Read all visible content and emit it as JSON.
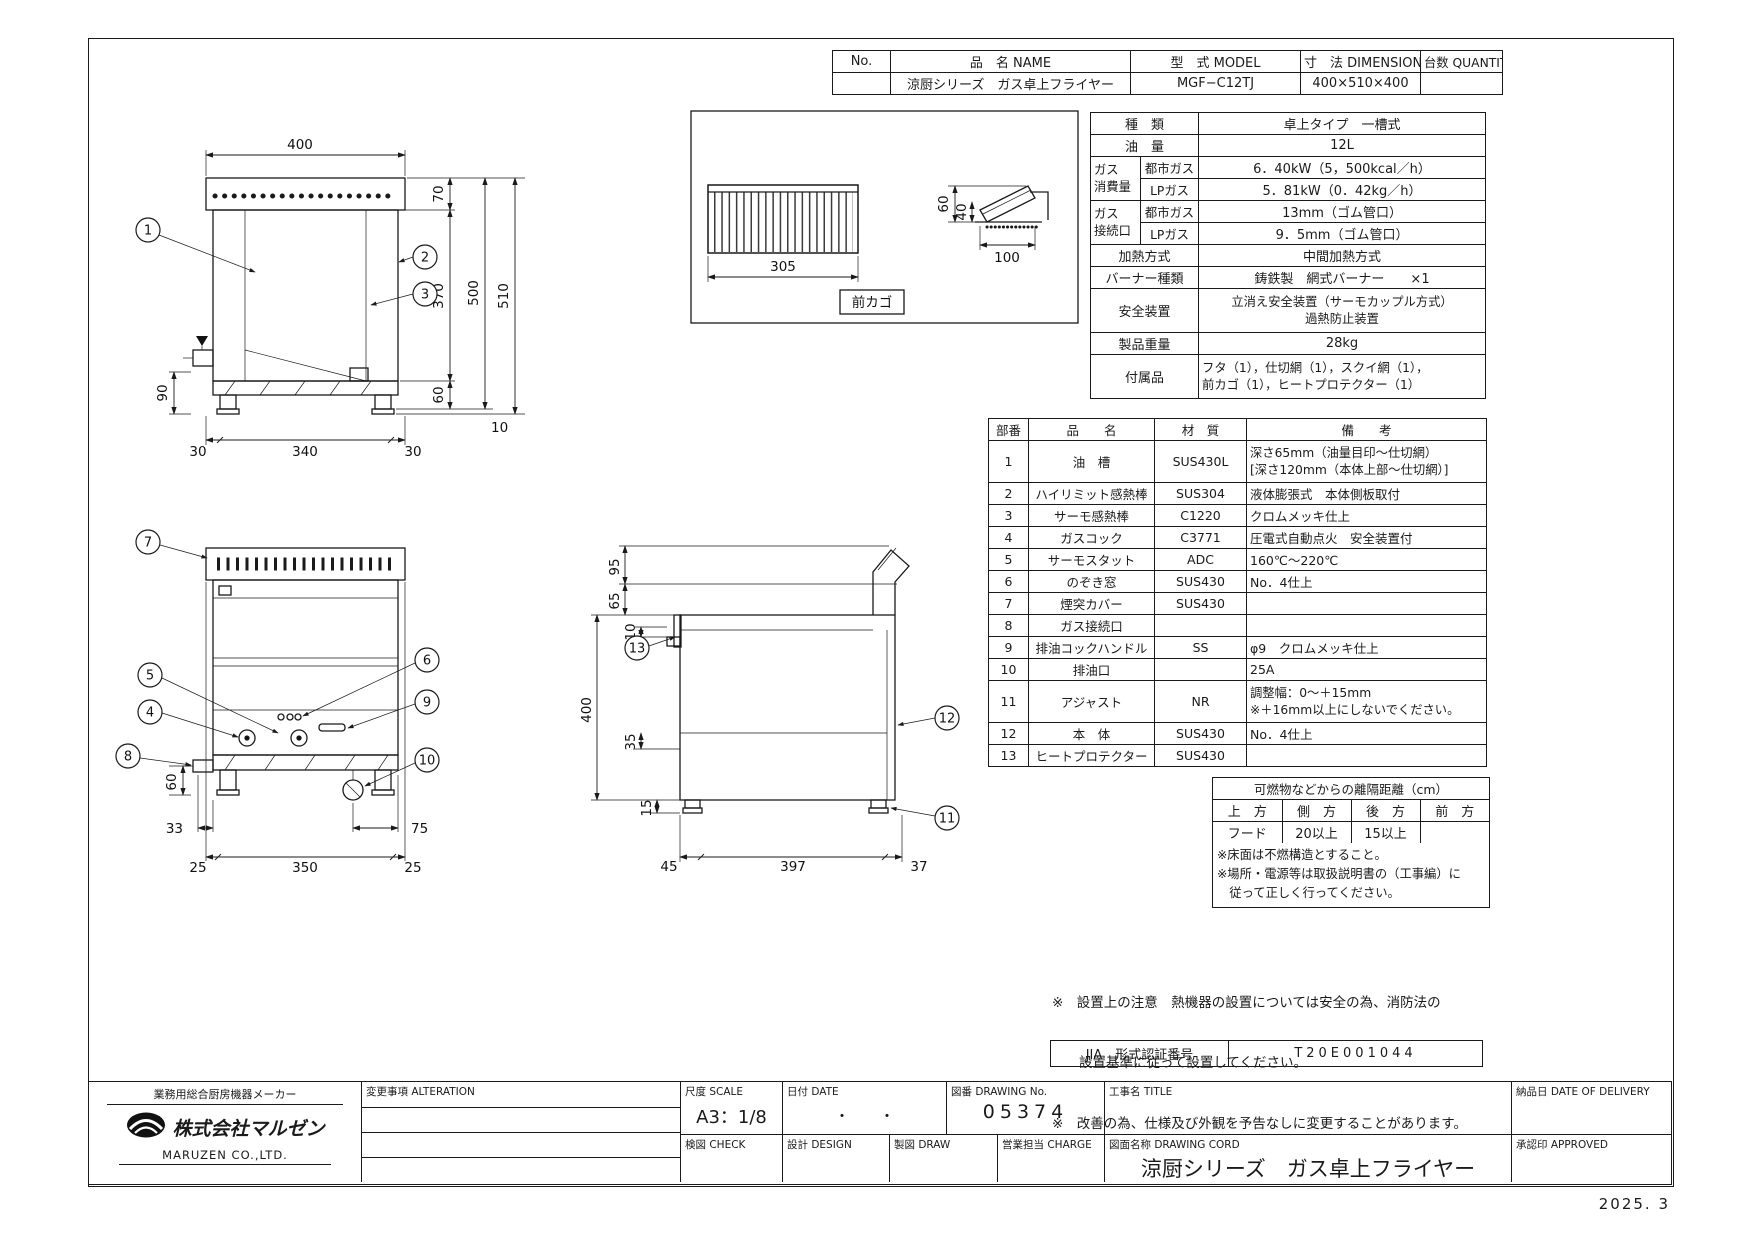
{
  "header_table": {
    "no_label": "No.",
    "name_label": "品　名 NAME",
    "model_label": "型　式 MODEL",
    "dim_label": "寸　法 DIMENSION",
    "qty_label": "台数 QUANTITY",
    "name": "涼厨シリーズ　ガス卓上フライヤー",
    "model": "MGF−C12TJ",
    "dimension": "400×510×400",
    "quantity": ""
  },
  "spec": {
    "kind_label": "種　類",
    "kind": "卓上タイプ　一槽式",
    "oil_label": "油　量",
    "oil": "12L",
    "cons_label1": "ガス",
    "cons_label2": "消費量",
    "conn_label1": "ガス",
    "conn_label2": "接続口",
    "city_gas": "都市ガス",
    "lp_gas": "LPガス",
    "cons_city": "6．40kW（5，500kcal／h）",
    "cons_lp": "5．81kW（0．42kg／h）",
    "conn_city": "13mm（ゴム管口）",
    "conn_lp": "9．5mm（ゴム管口）",
    "heating_label": "加熱方式",
    "heating": "中間加熱方式",
    "burner_label": "バーナー種類",
    "burner": "鋳鉄製　網式バーナー　　×1",
    "safety_label": "安全装置",
    "safety1": "立消え安全装置（サーモカップル方式）",
    "safety2": "過熱防止装置",
    "weight_label": "製品重量",
    "weight": "28kg",
    "acc_label": "付属品",
    "acc1": "フタ（1），仕切網（1），スクイ網（1），",
    "acc2": "前カゴ（1），ヒートプロテクター（1）"
  },
  "parts": {
    "h_no": "部番",
    "h_name": "品　　名",
    "h_material": "材　質",
    "h_remark": "備　　考",
    "rows": [
      {
        "no": "1",
        "name": "油　槽",
        "material": "SUS430L",
        "remark": "深さ65mm（油量目印～仕切網）",
        "remark2": "[深さ120mm（本体上部～仕切網）]"
      },
      {
        "no": "2",
        "name": "ハイリミット感熱棒",
        "material": "SUS304",
        "remark": "液体膨張式　本体側板取付"
      },
      {
        "no": "3",
        "name": "サーモ感熱棒",
        "material": "C1220",
        "remark": "クロムメッキ仕上"
      },
      {
        "no": "4",
        "name": "ガスコック",
        "material": "C3771",
        "remark": "圧電式自動点火　安全装置付"
      },
      {
        "no": "5",
        "name": "サーモスタット",
        "material": "ADC",
        "remark": "160℃～220℃"
      },
      {
        "no": "6",
        "name": "のぞき窓",
        "material": "SUS430",
        "remark": "No．4仕上"
      },
      {
        "no": "7",
        "name": "煙突カバー",
        "material": "SUS430",
        "remark": ""
      },
      {
        "no": "8",
        "name": "ガス接続口",
        "material": "",
        "remark": ""
      },
      {
        "no": "9",
        "name": "排油コックハンドル",
        "material": "SS",
        "remark": "φ9　クロムメッキ仕上"
      },
      {
        "no": "10",
        "name": "排油口",
        "material": "",
        "remark": "25A"
      },
      {
        "no": "11",
        "name": "アジャスト",
        "material": "NR",
        "remark": "調整幅：0～＋15mm",
        "remark2": "※＋16mm以上にしないでください。"
      },
      {
        "no": "12",
        "name": "本　体",
        "material": "SUS430",
        "remark": "No．4仕上"
      },
      {
        "no": "13",
        "name": "ヒートプロテクター",
        "material": "SUS430",
        "remark": ""
      }
    ]
  },
  "clearance": {
    "title": "可燃物などからの離隔距離（cm）",
    "h_top": "上　方",
    "h_side": "側　方",
    "h_rear": "後　方",
    "h_front": "前　方",
    "r_top": "フード",
    "r_side": "20以上",
    "r_rear": "15以上",
    "r_front": "",
    "note1": "※床面は不燃構造とすること。",
    "note2": "※場所・電源等は取扱説明書の（工事編）に",
    "note3": "　従って正しく行ってください。"
  },
  "install_notes": {
    "line1": "※　設置上の注意　熱機器の設置については安全の為、消防法の",
    "line2": "　　設置基準に従って設置してください。",
    "line3": "※　改善の為、仕様及び外観を予告なしに変更することがあります。"
  },
  "jia": {
    "label": "JIA　形式認証番号",
    "value": "T20E001044"
  },
  "title_block": {
    "tagline": "業務用総合厨房機器メーカー",
    "company": "株式会社マルゼン",
    "company_en": "MARUZEN  CO.,LTD.",
    "alteration": "変更事項  ALTERATION",
    "scale_label": "尺度  SCALE",
    "scale": "A3：1/8",
    "date_label": "日付  DATE",
    "date": "・　　・",
    "dwg_no_label": "図番  DRAWING No.",
    "dwg_no": "05374",
    "title_label": "工事名  TITLE",
    "delivery_label": "納品日  DATE OF DELIVERY",
    "check_label": "検図  CHECK",
    "design_label": "設計  DESIGN",
    "draw_label": "製図  DRAW",
    "charge_label": "営業担当 CHARGE",
    "dwg_name_label": "図面名称  DRAWING CORD",
    "dwg_name": "涼厨シリーズ　ガス卓上フライヤー",
    "approved_label": "承認印  APPROVED",
    "issue": "2025. 3"
  },
  "views": {
    "front": {
      "callouts": [
        "1",
        "2",
        "3"
      ],
      "dims": {
        "w400": "400",
        "c70": "70",
        "c370": "370",
        "c60": "60",
        "c500": "500",
        "c510": "510",
        "c10": "10",
        "l90": "90",
        "b30a": "30",
        "b340": "340",
        "b30b": "30"
      }
    },
    "basket": {
      "label": "前カゴ",
      "dims": {
        "w305": "305",
        "h60": "60",
        "h40": "40",
        "w100": "100"
      }
    },
    "front2": {
      "callouts": [
        "7",
        "5",
        "4",
        "8",
        "6",
        "9",
        "10"
      ],
      "dims": {
        "l60": "60",
        "b33": "33",
        "b75": "75",
        "b25a": "25",
        "b350": "350",
        "b25b": "25"
      }
    },
    "side": {
      "callouts": [
        "13",
        "12",
        "11"
      ],
      "dims": {
        "c95": "95",
        "c65": "65",
        "c10": "10",
        "c400": "400",
        "c35": "35",
        "c15": "15",
        "b45": "45",
        "b397": "397",
        "b37": "37"
      }
    }
  }
}
